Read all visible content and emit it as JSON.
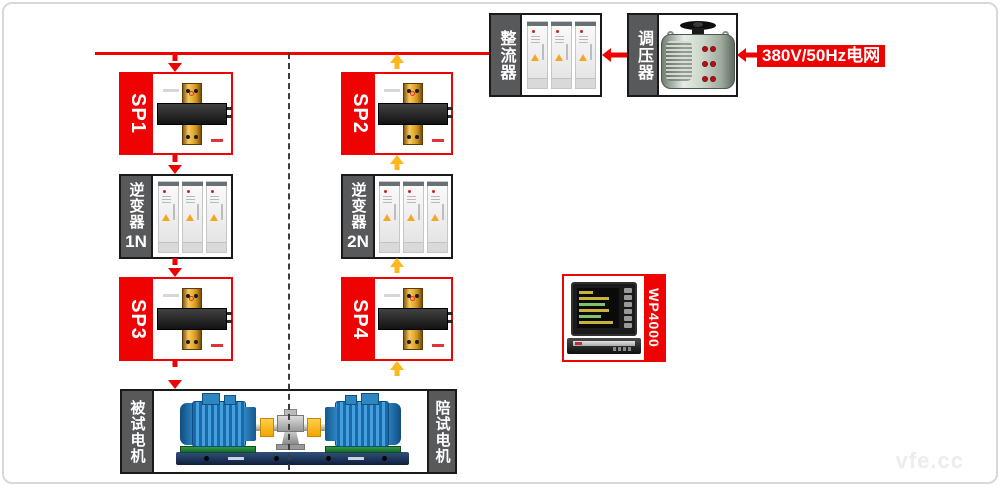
{
  "grid_label": "380V/50Hz电网",
  "nodes": {
    "rectifier": {
      "label": "整流器"
    },
    "regulator": {
      "label": "调压器"
    },
    "sp1": {
      "label": "SP1"
    },
    "sp2": {
      "label": "SP2"
    },
    "sp3": {
      "label": "SP3"
    },
    "sp4": {
      "label": "SP4"
    },
    "inverter1": {
      "label": "逆变器",
      "unit": "1N"
    },
    "inverter2": {
      "label": "逆变器",
      "unit": "2N"
    },
    "tested_motor": {
      "label": "被试电机"
    },
    "accompanying_motor": {
      "label": "陪试电机"
    },
    "analyzer": {
      "label": "WP4000"
    }
  },
  "watermark": "vfe.cc",
  "colors": {
    "accent_red": "#ee0202",
    "accent_yellow": "#ffb71b",
    "sidebar_gray": "#58595b"
  }
}
